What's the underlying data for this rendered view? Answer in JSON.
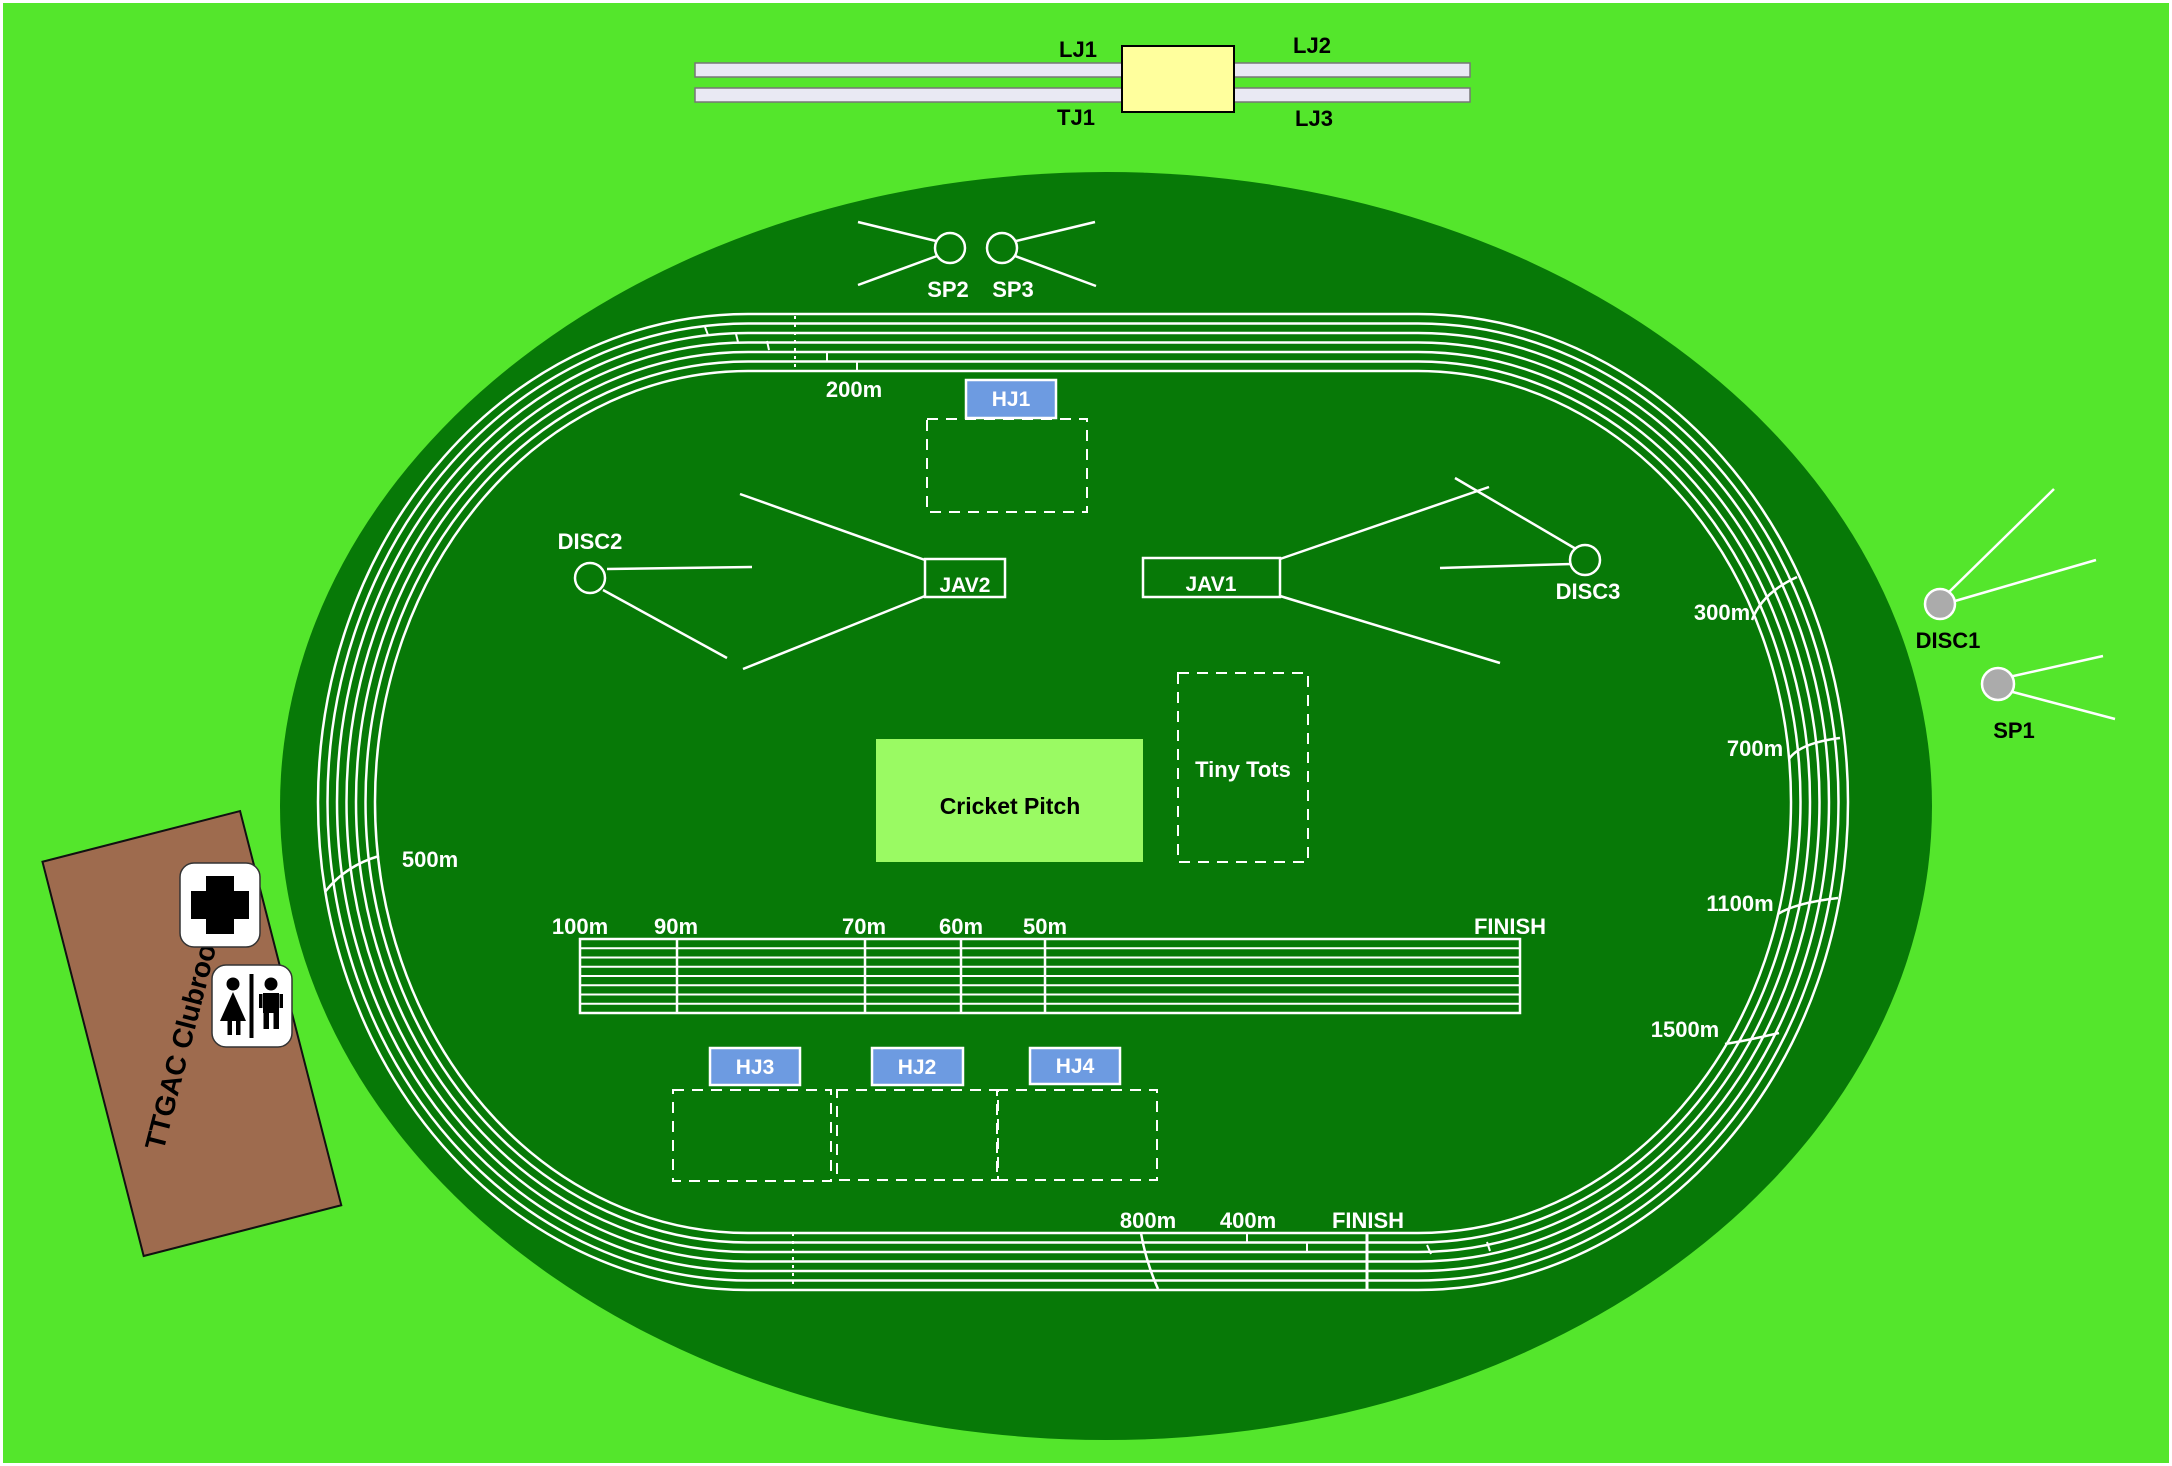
{
  "colors": {
    "background": "#54E62C",
    "track_green": "#077907",
    "cricket_pitch": "#9AFA63",
    "high_jump_blue": "#6D9BE1",
    "clubroom_brown": "#9E6B4E",
    "sand_yellow": "#FFFF9D",
    "runway_gray": "#E9E9F3",
    "equipment_gray": "#ABABAB"
  },
  "long_jump": {
    "lj1": "LJ1",
    "lj2": "LJ2",
    "tj1": "TJ1",
    "lj3": "LJ3"
  },
  "shot_put": {
    "sp1": "SP1",
    "sp2": "SP2",
    "sp3": "SP3"
  },
  "discus": {
    "disc1": "DISC1",
    "disc2": "DISC2",
    "disc3": "DISC3"
  },
  "javelin": {
    "jav1": "JAV1",
    "jav2": "JAV2"
  },
  "high_jump": {
    "hj1": "HJ1",
    "hj2": "HJ2",
    "hj3": "HJ3",
    "hj4": "HJ4"
  },
  "track_marks": {
    "m200": "200m",
    "m300": "300m",
    "m500": "500m",
    "m700": "700m",
    "m1100": "1100m",
    "m1500": "1500m",
    "m800": "800m",
    "m400": "400m",
    "finish": "FINISH"
  },
  "sprint_straight": {
    "m100": "100m",
    "m90": "90m",
    "m70": "70m",
    "m60": "60m",
    "m50": "50m",
    "finish": "FINISH"
  },
  "infield": {
    "cricket_pitch": "Cricket Pitch",
    "tiny_tots": "Tiny Tots"
  },
  "clubroom": {
    "name": "TTGAC Clubroom"
  },
  "icons": {
    "first_aid": "first-aid-cross-icon",
    "toilets": "toilets-icon"
  }
}
